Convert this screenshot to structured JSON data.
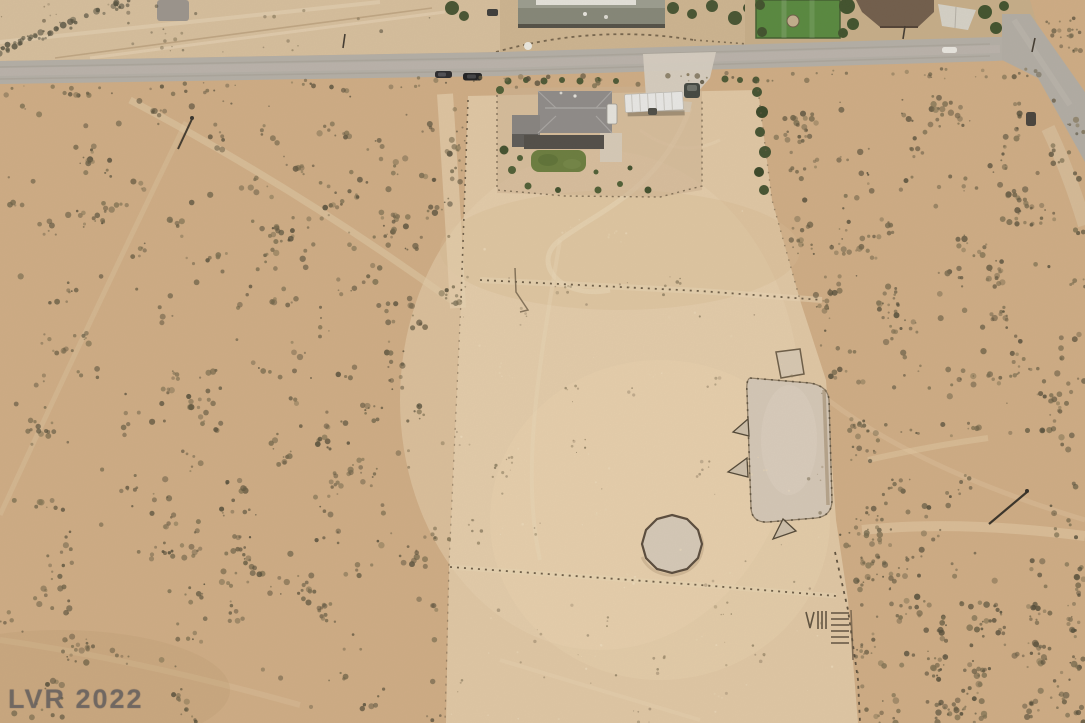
{
  "image": {
    "type": "aerial-drone-photo",
    "subject": "desert ranch parcel with house, arena and round pen",
    "watermark": "LVR 2022"
  },
  "palette": {
    "desert_sand": "#cfac84",
    "cleared_parcel": "#e0c7a4",
    "pale_lot": "#d7bf9d",
    "road_asphalt": "#b3aea6",
    "roof_gray": "#8d8a88",
    "lawn_green": "#687c3c",
    "neighbor_lawn_green": "#55883c",
    "canopy_white": "#e9e9e7",
    "shrub_dark": "#6a5e44",
    "fence_dark": "#6b5b45",
    "arena_surface": "#d4c7b7"
  },
  "features": {
    "vehicles_on_road": 2,
    "houses_visible": 3,
    "arena": "rectangular fenced arena",
    "round_pen": "circular livestock pen",
    "ground_marks": "VIII"
  }
}
